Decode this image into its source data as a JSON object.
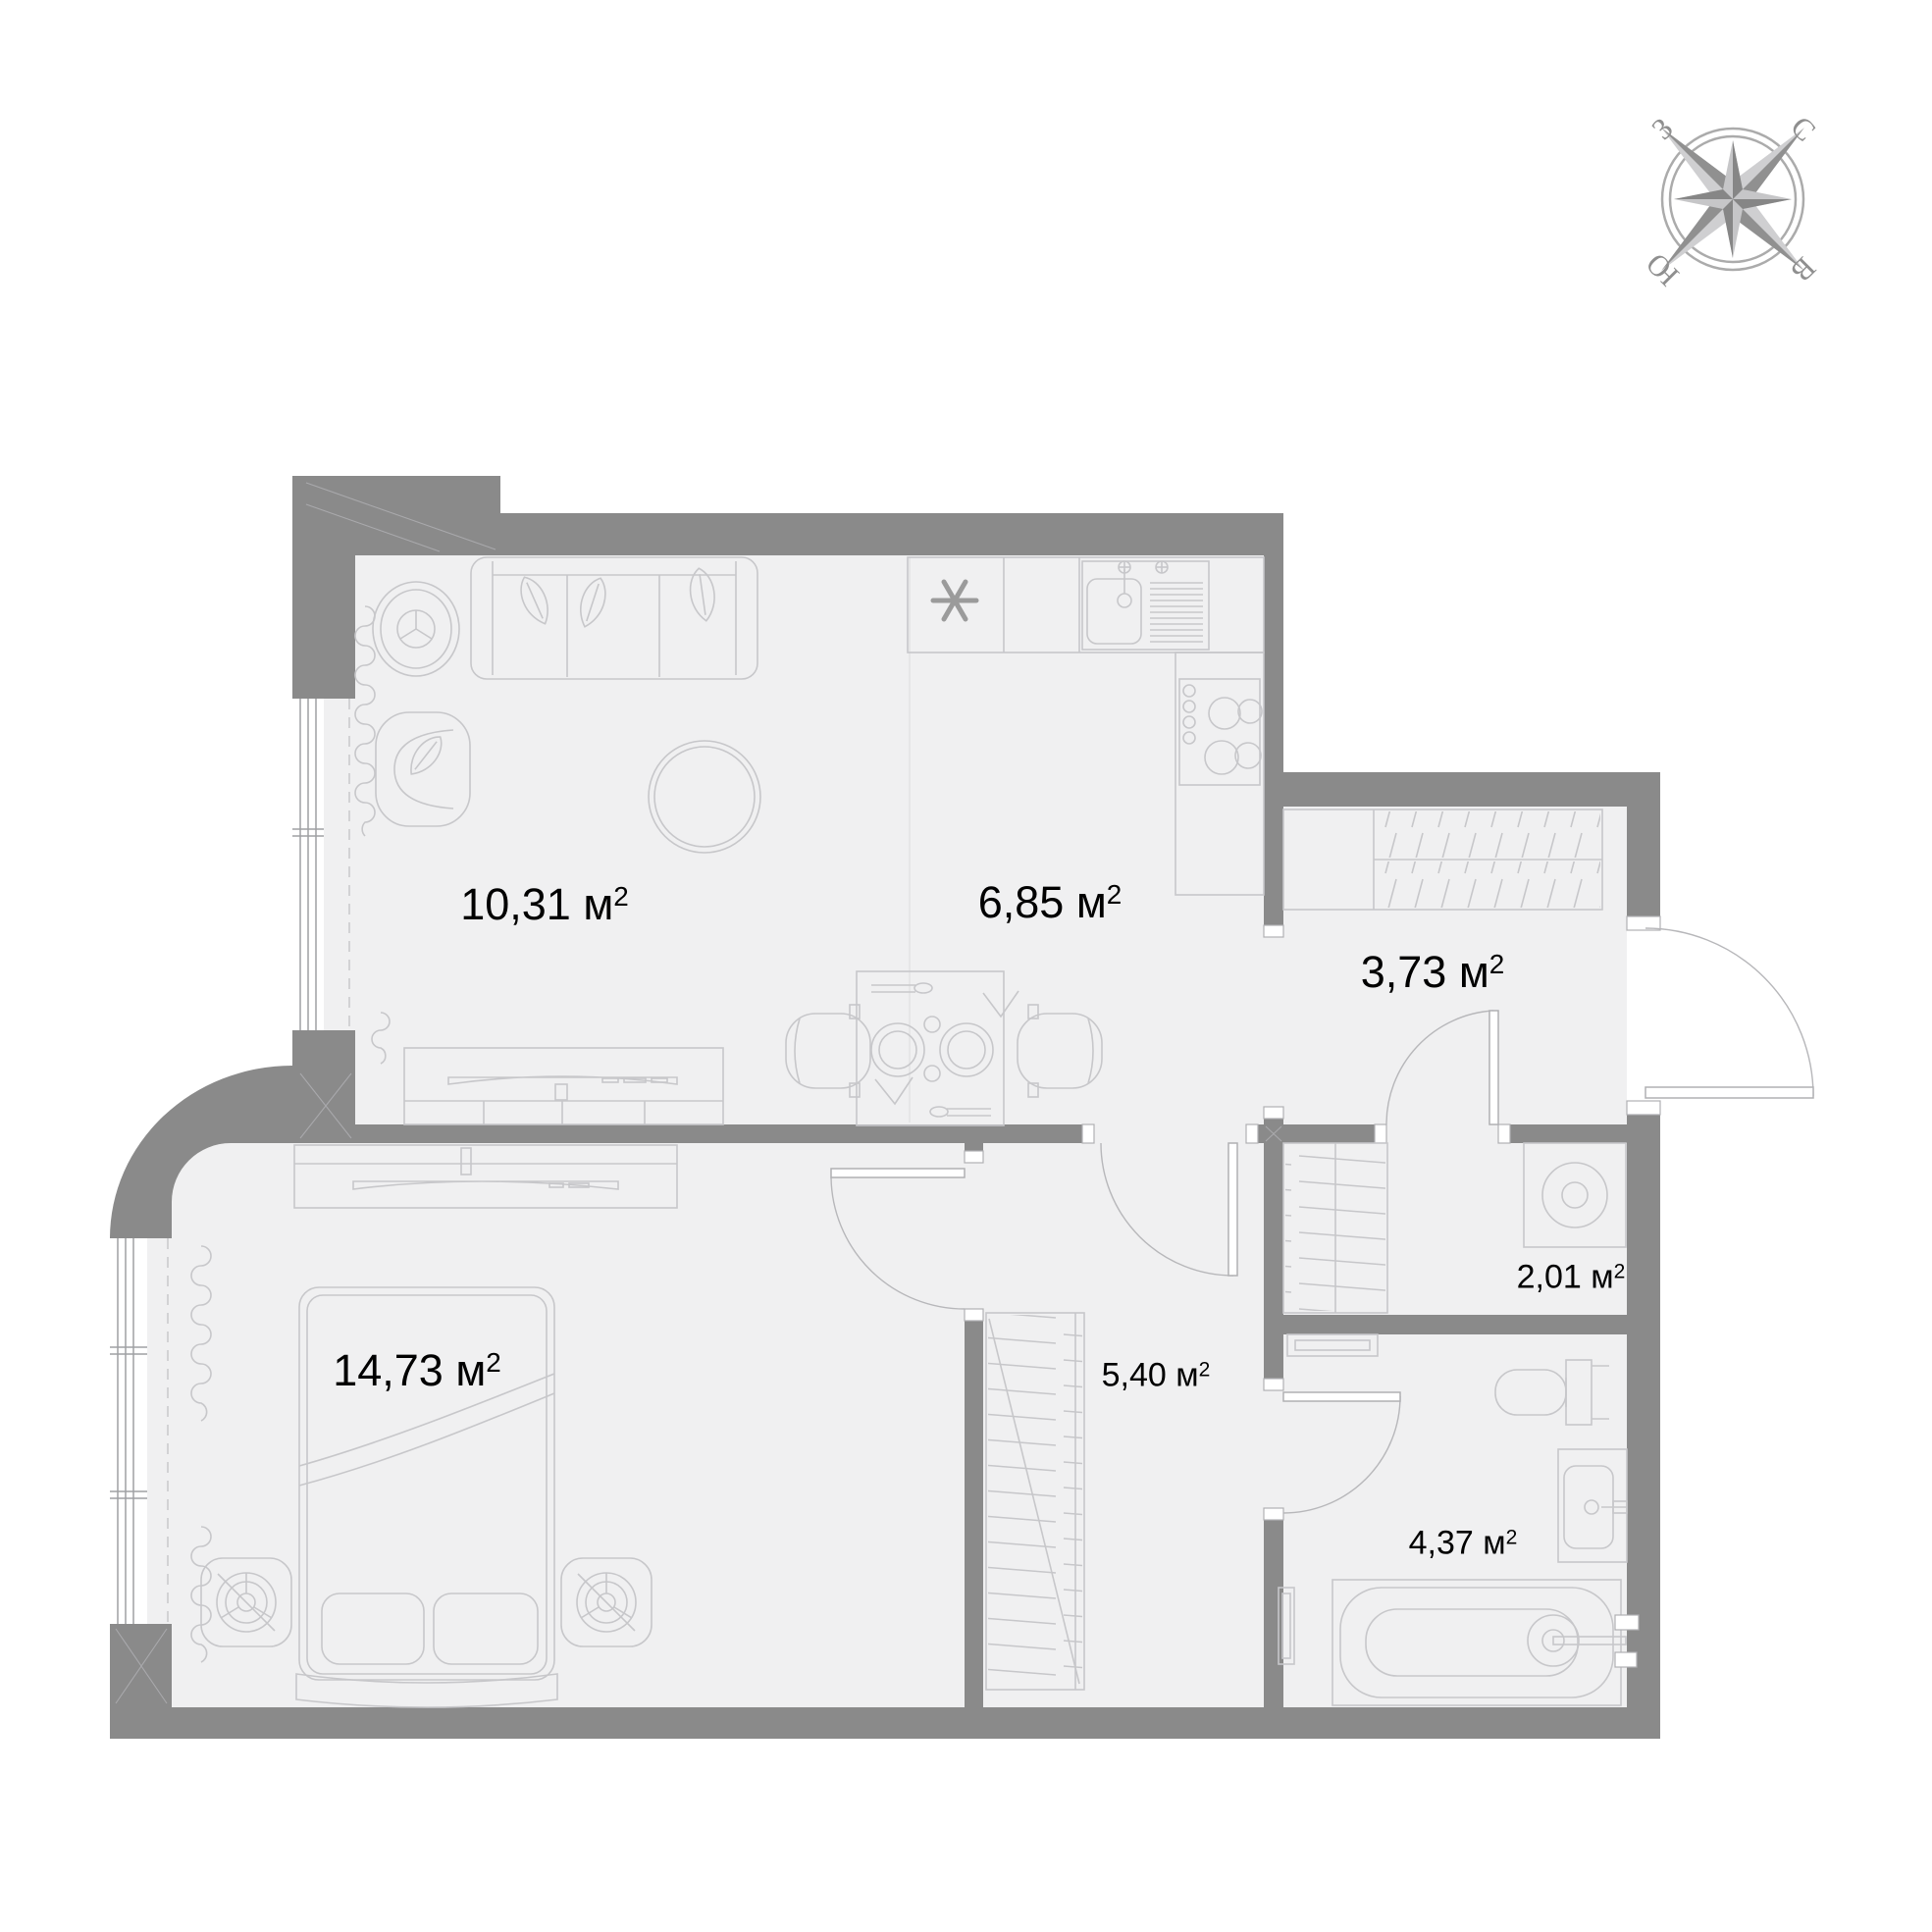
{
  "floor_plan": {
    "unit": "м",
    "sup": "2",
    "rooms": {
      "living": {
        "name": "living-room",
        "area": "10,31"
      },
      "kitchen": {
        "name": "kitchen",
        "area": "6,85"
      },
      "hallway": {
        "name": "hallway",
        "area": "3,73"
      },
      "wardrobe": {
        "name": "wardrobe-room",
        "area": "2,01"
      },
      "corridor": {
        "name": "corridor",
        "area": "5,40"
      },
      "bedroom": {
        "name": "bedroom",
        "area": "14,73"
      },
      "bathroom": {
        "name": "bathroom",
        "area": "4,37"
      }
    },
    "compass": {
      "north": "С",
      "east": "В",
      "south": "Ю",
      "west": "З"
    },
    "colors": {
      "wall": "#8a8a8a",
      "floor": "#f0f0f1",
      "line": "#c7c7ca",
      "text": "#000000",
      "compass": "#909090"
    }
  }
}
